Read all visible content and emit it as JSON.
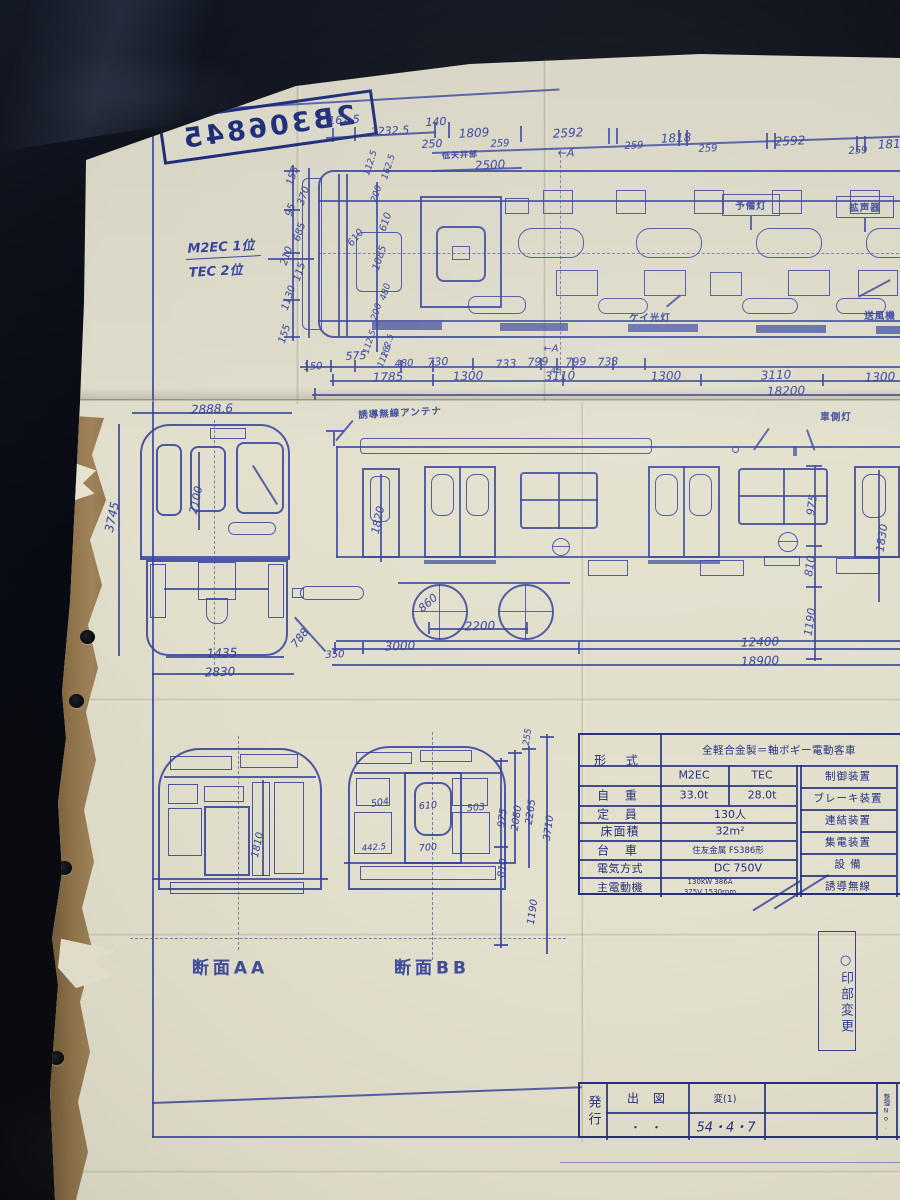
{
  "stamp": {
    "number": "2B306845"
  },
  "corner_note": "△50-4-7",
  "car_type": {
    "line1": "M2EC 1位",
    "line2": "TEC 2位"
  },
  "note_box": {
    "text": "○印部変更"
  },
  "sections": {
    "aa": "断面AA",
    "bb": "断面BB"
  },
  "title_block": {
    "issuer": "発行",
    "out_label": "出図",
    "out_value": "・・",
    "rev_label": "変(1)",
    "rev_value": "54・4・7",
    "ref_label": "整理No."
  },
  "spec_table": {
    "class_label": "形 式",
    "class_value": "全軽合金製＝軸ボギー電動客車",
    "models": [
      "M2EC",
      "TEC"
    ],
    "rows": [
      {
        "label": "自 重",
        "values": [
          "33.0t",
          "28.0t"
        ]
      },
      {
        "label": "定 員",
        "values": [
          "130人"
        ]
      },
      {
        "label": "床面積",
        "values": [
          "32m²"
        ]
      },
      {
        "label": "台 車",
        "values": [
          "住友金属 FS386形"
        ]
      },
      {
        "label": "電気方式",
        "values": [
          "DC 750V"
        ]
      },
      {
        "label": "主電動機",
        "values": [
          "130KW 386A",
          "375V 1530rpm"
        ]
      }
    ],
    "right_labels": [
      "制御装置",
      "ブレーキ装置",
      "連結装置",
      "集電装置",
      "設 備",
      "誘導無線"
    ]
  },
  "annotations": [
    [
      "162.5",
      344,
      120,
      -3,
      11
    ],
    [
      "1232.5",
      390,
      131,
      -3,
      11
    ],
    [
      "140",
      436,
      122,
      -3,
      11
    ],
    [
      "250",
      432,
      144,
      -3,
      11
    ],
    [
      "1809",
      474,
      133,
      -3,
      12
    ],
    [
      "259",
      500,
      144,
      -3,
      10
    ],
    [
      "2592",
      568,
      133,
      -3,
      12
    ],
    [
      "259",
      634,
      146,
      -3,
      10
    ],
    [
      "1818",
      676,
      138,
      -3,
      12
    ],
    [
      "259",
      708,
      149,
      -3,
      10
    ],
    [
      "2592",
      790,
      141,
      -3,
      12
    ],
    [
      "259",
      858,
      151,
      -3,
      10
    ],
    [
      "1818",
      893,
      144,
      -3,
      12
    ],
    [
      "低天井部",
      460,
      155,
      -3,
      8,
      "label"
    ],
    [
      "2500",
      490,
      165,
      -3,
      12
    ],
    [
      "←A",
      566,
      153,
      0,
      11,
      "marker"
    ],
    [
      "112.5",
      371,
      163,
      -72,
      9
    ],
    [
      "162.5",
      389,
      167,
      -72,
      9
    ],
    [
      "155",
      293,
      176,
      -72,
      10
    ],
    [
      "370",
      304,
      196,
      -72,
      10
    ],
    [
      "95",
      291,
      210,
      -72,
      10
    ],
    [
      "685",
      300,
      232,
      -72,
      10
    ],
    [
      "210",
      287,
      256,
      -72,
      10
    ],
    [
      "115",
      300,
      272,
      -72,
      10
    ],
    [
      "1130",
      289,
      298,
      -72,
      10
    ],
    [
      "155",
      285,
      334,
      -72,
      10
    ],
    [
      "610",
      356,
      238,
      -50,
      10
    ],
    [
      "200",
      377,
      194,
      -72,
      9
    ],
    [
      "610",
      386,
      222,
      -72,
      10
    ],
    [
      "1085",
      380,
      258,
      -72,
      10
    ],
    [
      "480",
      386,
      292,
      -72,
      9
    ],
    [
      "200",
      377,
      312,
      -72,
      9
    ],
    [
      "112.5",
      370,
      342,
      -72,
      8.5
    ],
    [
      "162.5",
      388,
      346,
      -72,
      8.5
    ],
    [
      "予備灯",
      751,
      205,
      0,
      9.5,
      "label"
    ],
    [
      "拡声器",
      865,
      207,
      0,
      9.5,
      "label"
    ],
    [
      "ケイ光灯",
      650,
      317,
      0,
      9.5,
      "label"
    ],
    [
      "送風機",
      880,
      315,
      0,
      9.5,
      "label"
    ],
    [
      "150",
      313,
      367,
      -3,
      10
    ],
    [
      "575",
      356,
      356,
      -3,
      11
    ],
    [
      "112.5",
      385,
      356,
      -68,
      8.5
    ],
    [
      "480",
      404,
      364,
      -3,
      10
    ],
    [
      "730",
      438,
      362,
      -3,
      11
    ],
    [
      "733",
      506,
      364,
      -3,
      11
    ],
    [
      "799",
      538,
      362,
      -3,
      11
    ],
    [
      "46",
      556,
      371,
      -3,
      8.5
    ],
    [
      "799",
      576,
      362,
      -3,
      11
    ],
    [
      "733",
      608,
      362,
      -3,
      11
    ],
    [
      "←A",
      551,
      349,
      0,
      10,
      "marker"
    ],
    [
      "1785",
      388,
      377,
      -2,
      12
    ],
    [
      "1300",
      468,
      376,
      -2,
      12
    ],
    [
      "3110",
      560,
      376,
      -2,
      12
    ],
    [
      "1300",
      666,
      376,
      -2,
      12
    ],
    [
      "3110",
      776,
      375,
      -2,
      12
    ],
    [
      "1300",
      880,
      377,
      -2,
      12
    ],
    [
      "18200",
      786,
      391,
      -2,
      12
    ],
    [
      "2888.6",
      212,
      409,
      -2,
      12
    ],
    [
      "3745",
      112,
      517,
      -78,
      12
    ],
    [
      "2100",
      196,
      500,
      -78,
      11
    ],
    [
      "1435",
      222,
      653,
      -2,
      12
    ],
    [
      "2830",
      220,
      672,
      -2,
      12
    ],
    [
      "788",
      300,
      638,
      -52,
      11
    ],
    [
      "誘導無線アンテナ",
      400,
      412,
      -3,
      9.5,
      "label"
    ],
    [
      "1820",
      378,
      520,
      -78,
      11
    ],
    [
      "車側灯",
      836,
      416,
      0,
      9.5,
      "label"
    ],
    [
      "975",
      812,
      505,
      -82,
      11
    ],
    [
      "810",
      810,
      566,
      -82,
      11
    ],
    [
      "1190",
      810,
      622,
      -82,
      11
    ],
    [
      "1830",
      882,
      538,
      -82,
      11
    ],
    [
      "860",
      428,
      603,
      -42,
      11
    ],
    [
      "2200",
      480,
      626,
      -2,
      12
    ],
    [
      "3000",
      400,
      646,
      -2,
      12
    ],
    [
      "350",
      335,
      655,
      -2,
      10
    ],
    [
      "12400",
      760,
      642,
      -2,
      12
    ],
    [
      "18900",
      760,
      661,
      -2,
      12
    ],
    [
      "1810",
      258,
      845,
      -78,
      10
    ],
    [
      "504",
      380,
      803,
      -8,
      9.5
    ],
    [
      "610",
      428,
      806,
      -5,
      9.5
    ],
    [
      "503",
      476,
      808,
      -5,
      9.5
    ],
    [
      "442.5",
      374,
      848,
      -5,
      8.5
    ],
    [
      "700",
      428,
      848,
      -5,
      9.5
    ],
    [
      "975",
      503,
      818,
      -82,
      10
    ],
    [
      "2080",
      517,
      818,
      -82,
      10
    ],
    [
      "2265",
      531,
      812,
      -82,
      10
    ],
    [
      "3710",
      549,
      828,
      -82,
      10
    ],
    [
      "810",
      503,
      868,
      -82,
      10
    ],
    [
      "1190",
      533,
      912,
      -82,
      10
    ],
    [
      "255",
      528,
      737,
      -82,
      9
    ],
    [
      "断面AA",
      230,
      966,
      0,
      17,
      "caption"
    ],
    [
      "断面BB",
      432,
      966,
      0,
      17,
      "caption"
    ],
    [
      "△50-4-7",
      106,
      127,
      -10,
      8.5,
      "note"
    ]
  ]
}
